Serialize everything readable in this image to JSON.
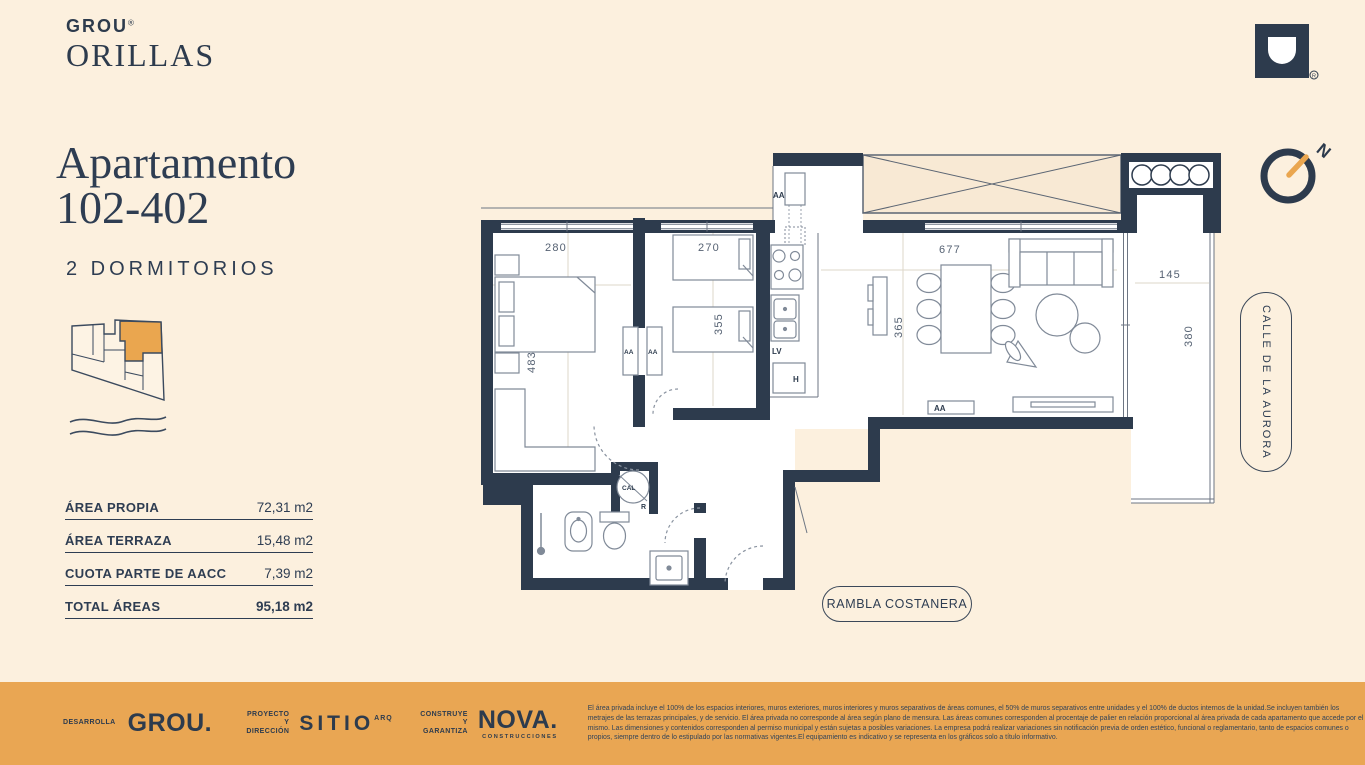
{
  "brand": {
    "name": "GROU",
    "reg": "®",
    "project": "ORILLAS"
  },
  "title": {
    "line1": "Apartamento",
    "line2": "102-402",
    "subtitle": "2 DORMITORIOS"
  },
  "areas": {
    "rows": [
      {
        "label": "ÁREA PROPIA",
        "value": "72,31 m2"
      },
      {
        "label": "ÁREA TERRAZA",
        "value": "15,48 m2"
      },
      {
        "label": "CUOTA PARTE DE AACC",
        "value": "7,39 m2"
      },
      {
        "label": "TOTAL ÁREAS",
        "value": "95,18 m2"
      }
    ]
  },
  "plan": {
    "dims": {
      "bed1_w": "280",
      "bed1_h": "483",
      "bed2_w": "270",
      "bed2_h": "355",
      "living_w": "677",
      "living_h": "365",
      "terrace_w": "145",
      "terrace_h": "380"
    },
    "labels": {
      "aa": "AA",
      "lv": "LV",
      "h": "H",
      "cal": "CAL",
      "r": "R"
    },
    "compass_n": "N",
    "streets": {
      "right": "CALLE DE LA AURORA",
      "bottom": "RAMBLA COSTANERA"
    }
  },
  "footer": {
    "dev_role": "DESARROLLA",
    "dev_logo": "GROU.",
    "dev_reg": "®",
    "arch_role_1": "PROYECTO",
    "arch_role_2": "Y DIRECCIÓN",
    "arch_logo": "SITIO",
    "arch_sup": "ARQ",
    "build_role_1": "CONSTRUYE",
    "build_role_2": "Y GARANTIZA",
    "build_logo": "NOVA.",
    "build_sub": "CONSTRUCCIONES",
    "legal": "El área privada incluye el 100% de los espacios interiores, muros exteriores, muros interiores y muros separativos de áreas comunes, el 50% de muros separativos entre unidades y el 100% de ductos internos de la unidad.Se incluyen también los metrajes de las terrazas principales, y de servicio. El área privada no corresponde al área según plano de mensura. Las áreas comunes corresponden al procentaje de palier en relación proporcional al área privada de cada apartamento que accede por el mismo. Las dimensiones y contenidos corresponden al permiso municipal y están sujetas a posibles variaciones. La empresa podrá realizar variaciones sin notificación previa de orden estético, funcional o reglamentario, tanto de espacios comunes o propios, siempre dentro de lo estipulado por las normativas vigentes.El equipamiento es indicativo y se representa en los gráficos solo a título informativo."
  },
  "colors": {
    "background": "#fcf0de",
    "navy": "#2d3b4d",
    "accent_orange": "#eaa64f",
    "footer_bg": "#e9a653",
    "void_tan": "#f8e9d4"
  }
}
